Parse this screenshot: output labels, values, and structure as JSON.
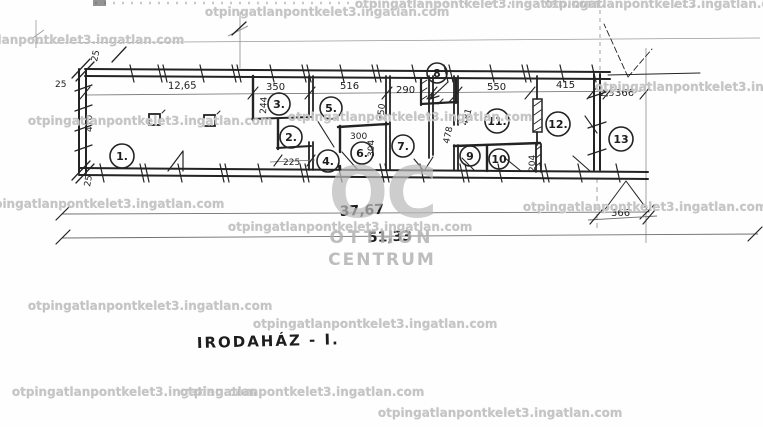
{
  "watermark": {
    "text": "otpingatlanpontkelet3.ingatlan.com"
  },
  "logo": {
    "initials": "OC",
    "name_line1": "OTTHON",
    "name_line2": "CENTRUM"
  },
  "plan": {
    "title": "IRODAHÁZ - I.",
    "rooms": [
      {
        "label": "1."
      },
      {
        "label": "2."
      },
      {
        "label": "3."
      },
      {
        "label": "4."
      },
      {
        "label": "5."
      },
      {
        "label": "6."
      },
      {
        "label": "7."
      },
      {
        "label": "8"
      },
      {
        "label": "9"
      },
      {
        "label": "10"
      },
      {
        "label": "11."
      },
      {
        "label": "12."
      },
      {
        "label": "13"
      }
    ],
    "dims": {
      "offset_top_left": "25",
      "offset_top": "25",
      "offset_bottom": "25",
      "left_depth": "410",
      "top_left_span": "12,65",
      "room3_width": "350",
      "room5_width": "516",
      "entry_width": "290",
      "room11_width": "550",
      "room12_width": "415",
      "right_small": "2,5",
      "right_span_top": "366",
      "room3_depth": "244",
      "passage_width": "225",
      "room5_depth": "350",
      "room6_width": "300",
      "room6_depth": "304",
      "room7_depth": "478",
      "hall_depth": "481",
      "room10_depth": "204",
      "right_span_bottom": "366",
      "building_length": "37,67",
      "total_length": "51,33"
    }
  }
}
